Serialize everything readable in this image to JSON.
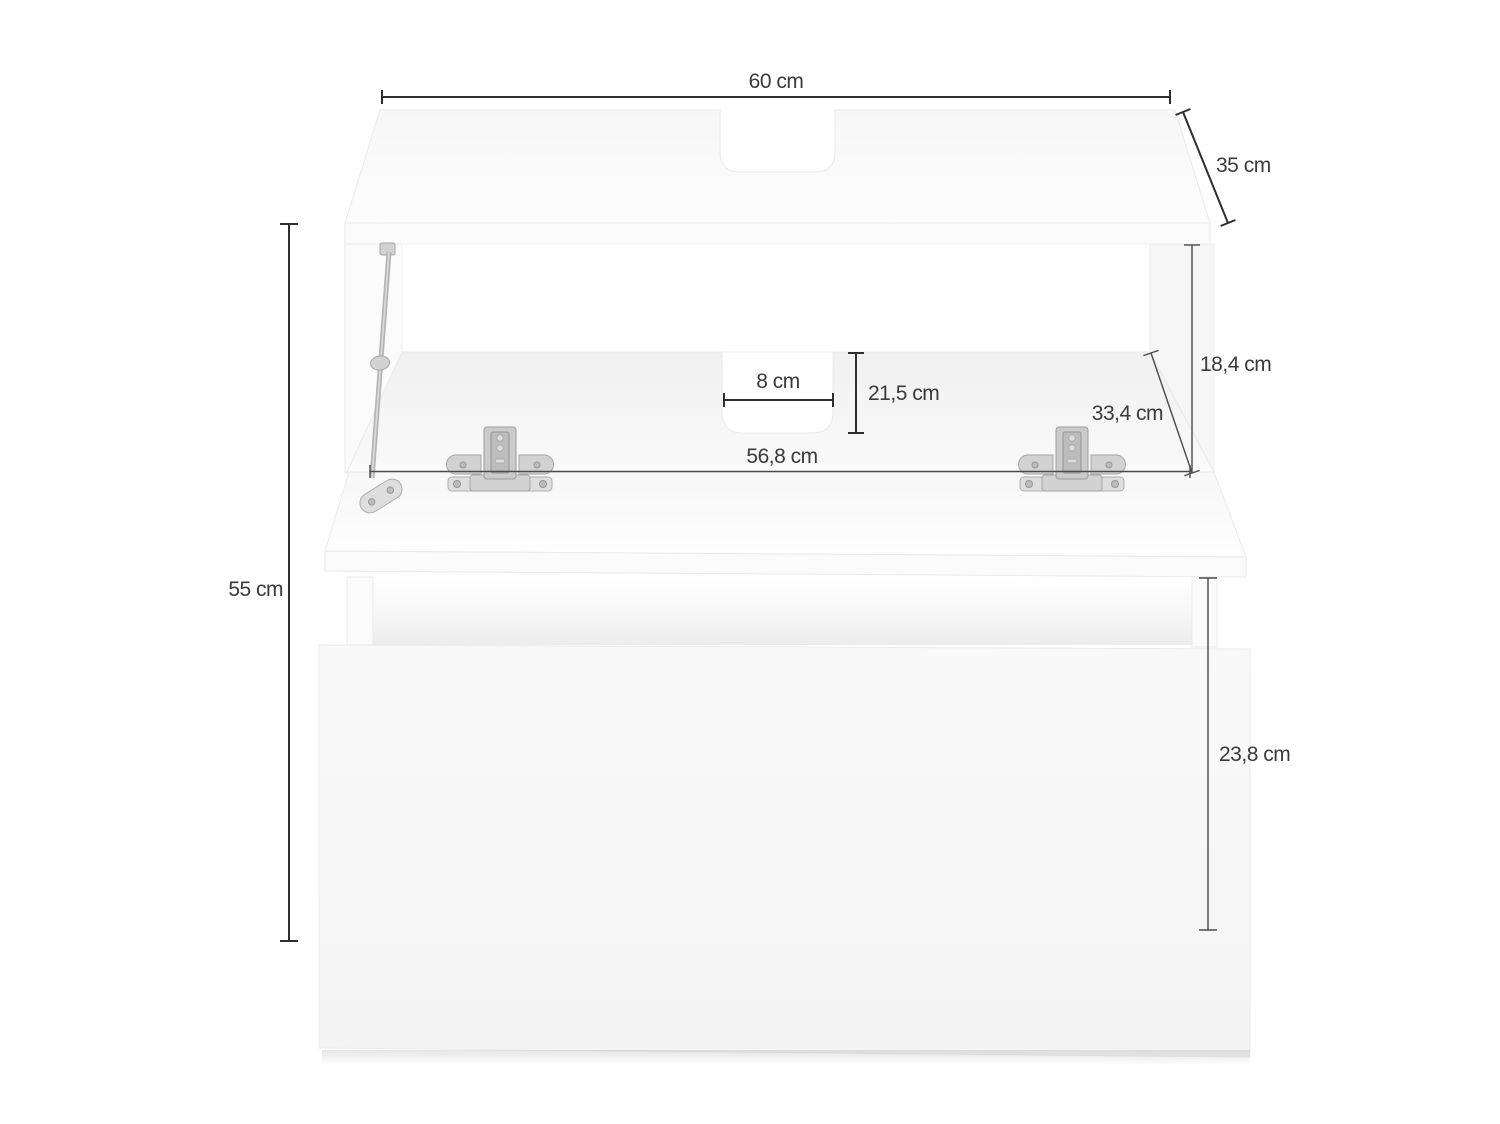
{
  "diagram": {
    "type": "furniture-dimension-diagram",
    "dimensions": {
      "overall_width": "60 cm",
      "overall_depth": "35 cm",
      "overall_height": "55 cm",
      "cutout_width": "8 cm",
      "cutout_depth": "21,5 cm",
      "interior_width": "56,8 cm",
      "interior_height": "18,4 cm",
      "interior_depth": "33,4 cm",
      "drawer_front_height": "23,8 cm"
    },
    "colors": {
      "background": "#ffffff",
      "dimension_line": "#2e2e2e",
      "label_text": "#3a3a3a",
      "panel_surface": "#fbfbfb",
      "panel_edge": "#e9e9e9",
      "metal_fitting": "#cbcbcb"
    }
  }
}
